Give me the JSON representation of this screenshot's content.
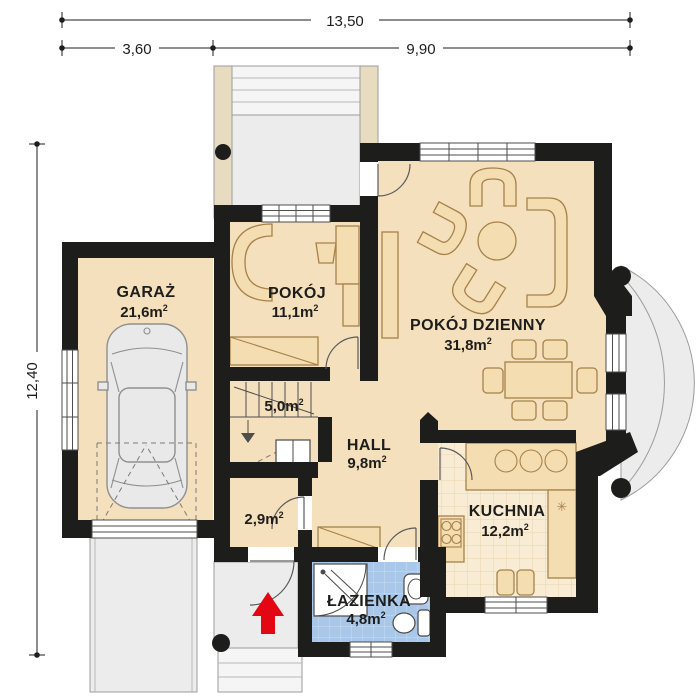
{
  "plan": {
    "dimensions": {
      "total_width": "13,50",
      "segment_left": "3,60",
      "segment_right": "9,90",
      "total_depth": "12,40"
    },
    "area_superscript": "2",
    "rooms": {
      "garaz": {
        "name": "GARAŻ",
        "area": "21,6m"
      },
      "pokoj": {
        "name": "POKÓJ",
        "area": "11,1m"
      },
      "pokoj_dzienny": {
        "name": "POKÓJ DZIENNY",
        "area": "31,8m"
      },
      "hall": {
        "name": "HALL",
        "area": "9,8m"
      },
      "kuchnia": {
        "name": "KUCHNIA",
        "area": "12,2m"
      },
      "lazienka": {
        "name": "ŁAZIENKA",
        "area": "4,8m"
      },
      "schody": {
        "area": "5,0m"
      },
      "garderoba": {
        "area": "2,9m"
      }
    },
    "icons": {
      "freezer": "✳"
    },
    "colors": {
      "wall": "#1d1d1b",
      "ink": "#1d1d1b",
      "floor": "#f5e0bd",
      "kfloor": "#f9ecd4",
      "kgrid": "#e8d4ae",
      "bath": "#a9c7e8",
      "bathgrid": "#c9dcf3",
      "furn": "#f5ddb2",
      "furnline": "#a5824a",
      "pave": "#ececec",
      "pavelight": "#f5f5f5",
      "paveline": "#9b9b9b",
      "column": "#e8dcc0",
      "car": "#e9e9e9",
      "carline": "#8f8f8f",
      "winline": "#4e4e4e",
      "red": "#e30613"
    }
  }
}
